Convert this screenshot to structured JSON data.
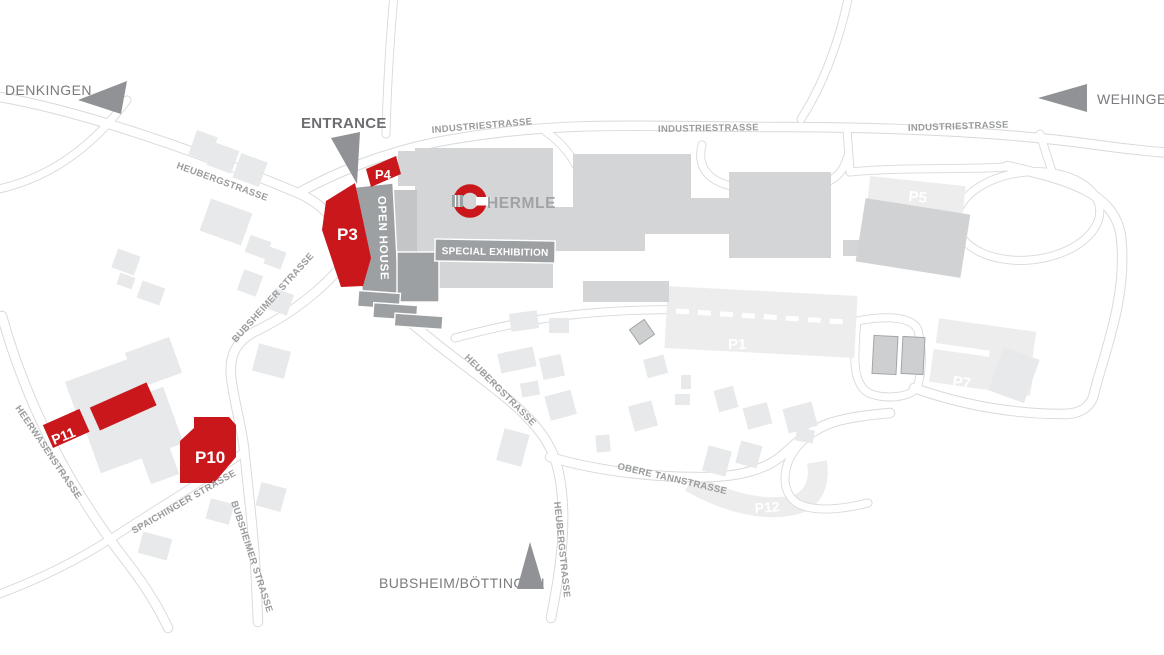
{
  "map": {
    "brand": "HERMLE",
    "entrance_label": "ENTRANCE",
    "destinations": {
      "denkingen": "DENKINGEN",
      "wehingen": "WEHINGEN",
      "bubsheim_boettingen": "BUBSHEIM/BÖTTINGEN"
    },
    "streets": {
      "industriestrasse": "INDUSTRIESTRASSE",
      "heubergstrasse": "HEUBERGSTRASSE",
      "bubsheimer_strasse": "BUBSHEIMER STRASSE",
      "spaichinger_strasse": "SPAICHINGER STRASSE",
      "heerwasenstrasse": "HEERWASENSTRASSE",
      "obere_tannstrasse": "OBERE TANNSTRASSE"
    },
    "zones": {
      "open_house": "OPEN HOUSE",
      "special_exhibition": "SPECIAL EXHIBITION"
    },
    "parking": {
      "p1": "P1",
      "p3": "P3",
      "p4": "P4",
      "p5": "P5",
      "p7": "P7",
      "p10": "P10",
      "p11": "P11",
      "p12": "P12"
    },
    "colors": {
      "accent_red": "#c9171b",
      "building_main": "#d3d5d6",
      "building_dark": "#9da0a2",
      "building_light": "#e8e9ea",
      "parking_light": "#ededee",
      "arrow_gray": "#909295",
      "road_line": "#d8d9da",
      "street_label": "#999b9d",
      "city_label": "#797b7e"
    }
  }
}
